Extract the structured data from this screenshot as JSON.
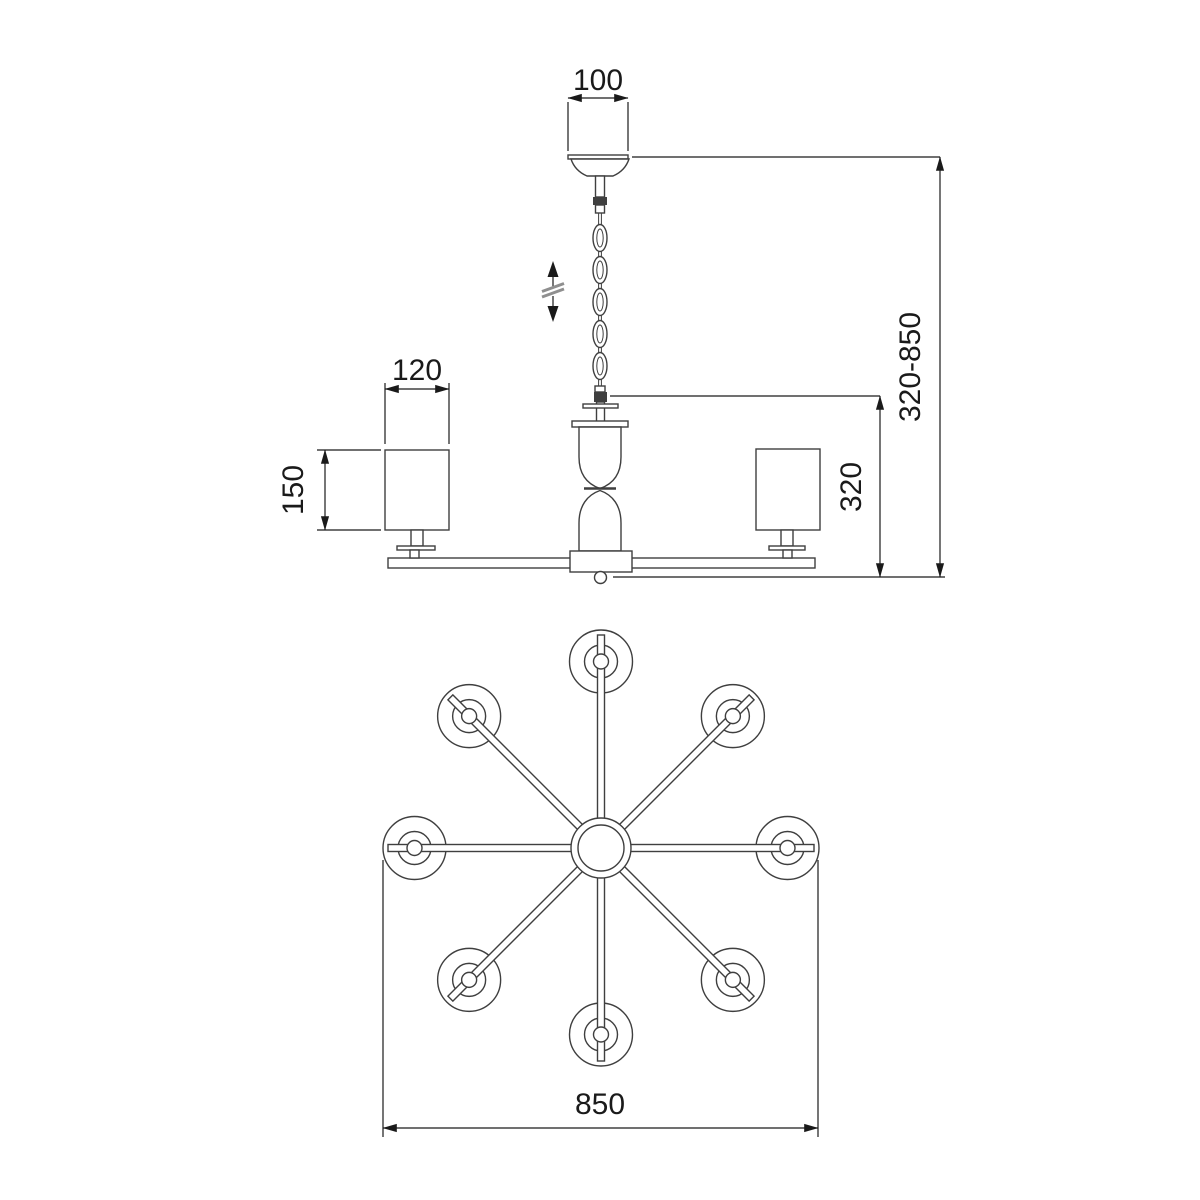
{
  "drawing": {
    "type": "technical-dimension-drawing",
    "subject": "8-arm chandelier, side elevation and plan view",
    "dimensions": {
      "canopy_width": "100",
      "shade_width": "120",
      "shade_height": "150",
      "body_height": "320",
      "overall_height": "320-850",
      "plan_diameter": "850"
    },
    "icons": {
      "height_adjustable": "up-down-arrows-with-break"
    },
    "side_view": {
      "chain_links": 5
    },
    "plan_view": {
      "arm_count": 8,
      "shade_count": 8
    },
    "colors": {
      "line": "#3f3f3f",
      "dimension": "#1a1a1a",
      "background": "#ffffff"
    }
  }
}
